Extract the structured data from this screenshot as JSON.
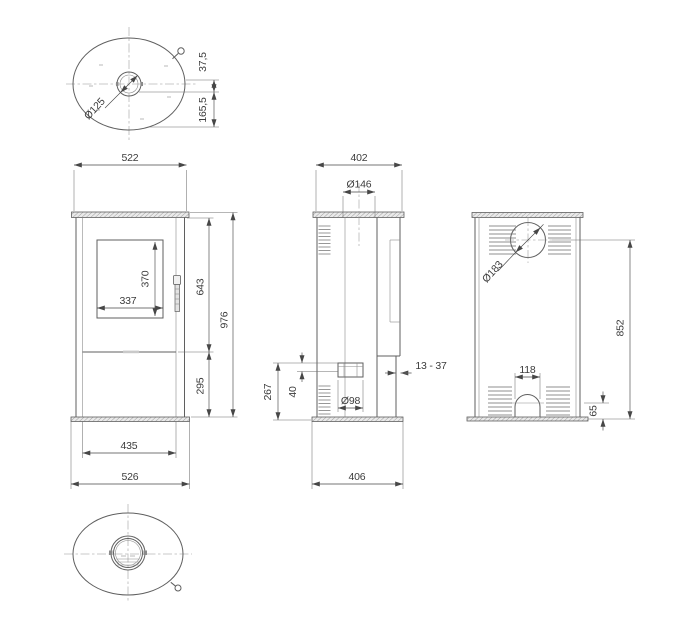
{
  "colors": {
    "background": "#ffffff",
    "line": "#5f5f5f",
    "dimension": "#474747",
    "text": "#3c3c3c"
  },
  "views": {
    "top": {
      "dims": {
        "flue_diameter": "Ø125",
        "flue_offset": "37,5",
        "rear_offset": "165,5"
      }
    },
    "front": {
      "dims": {
        "top_plate_width": "522",
        "glass_height": "370",
        "glass_width": "337",
        "upper_section_height": "643",
        "total_height": "976",
        "lower_section_height": "295",
        "front_panel_width": "435",
        "base_plate_width": "526"
      }
    },
    "side": {
      "dims": {
        "depth": "402",
        "top_flue_diameter": "Ø146",
        "rear_outlet_height": "267",
        "rear_outlet_offset": "40",
        "rear_outlet_diameter": "Ø98",
        "wall_gap_range": "13 - 37",
        "base_plate_depth": "406"
      }
    },
    "back": {
      "dims": {
        "rear_flue_diameter": "Ø183",
        "rear_flue_center_height": "852",
        "bottom_opening_width": "118",
        "bottom_opening_height": "65"
      }
    }
  }
}
